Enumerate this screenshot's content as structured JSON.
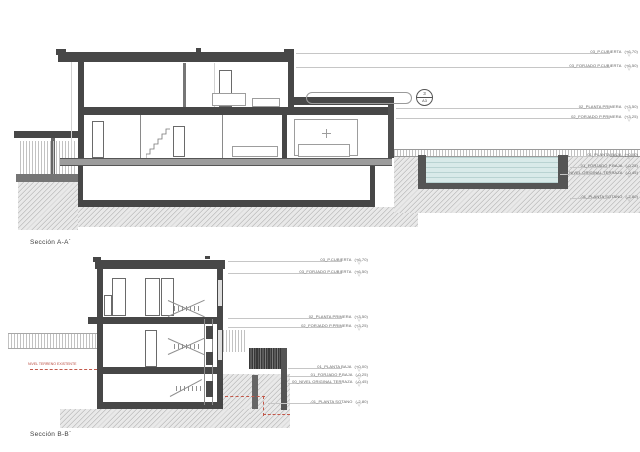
{
  "page": {
    "background": "#ffffff"
  },
  "section_a": {
    "title": "Sección A-A´",
    "callout": {
      "number": "3",
      "sheet": "A3"
    },
    "levels": [
      {
        "label": "03_P.CUBIERTA",
        "value": "(+6,70)"
      },
      {
        "label": "03_FORJADO P.CUBIERTA",
        "value": "(+6,50)"
      },
      {
        "label": "02_PLANTA PRIMERA",
        "value": "(+3,50)"
      },
      {
        "label": "02_FORJADO P.PRIMERA",
        "value": "(+3,25)"
      },
      {
        "label": "01_PLANTA BAJA",
        "value": "(+0,00)"
      },
      {
        "label": "01_FORJADO P.BAJA",
        "value": "(-0,25)"
      },
      {
        "label": "00_NIVEL ORIGINAL TERRAZA",
        "value": "(-0,45)"
      },
      {
        "label": "-01_PLANTA SOTANO",
        "value": "(-2,80)"
      }
    ]
  },
  "section_b": {
    "title": "Sección B-B´",
    "annotation": "NIVEL TERRENO EXISTENTE",
    "levels": [
      {
        "label": "03_P.CUBIERTA",
        "value": "(+6,70)"
      },
      {
        "label": "03_FORJADO P.CUBIERTA",
        "value": "(+6,50)"
      },
      {
        "label": "02_PLANTA PRIMERA",
        "value": "(+3,50)"
      },
      {
        "label": "02_FORJADO P.PRIMERA",
        "value": "(+3,25)"
      },
      {
        "label": "01_PLANTA BAJA",
        "value": "(+0,00)"
      },
      {
        "label": "01_FORJADO P.BAJA",
        "value": "(-0,25)"
      },
      {
        "label": "00_NIVEL ORIGINAL TERRAZA",
        "value": "(-0,45)"
      },
      {
        "label": "-01_PLANTA SOTANO",
        "value": "(-2,80)"
      }
    ]
  },
  "colors": {
    "structure": "#474747",
    "water": "#d9eae9",
    "terrain": "#e9e9e9",
    "annotation_red": "#b8463a",
    "level_line": "#c6c6c6"
  }
}
